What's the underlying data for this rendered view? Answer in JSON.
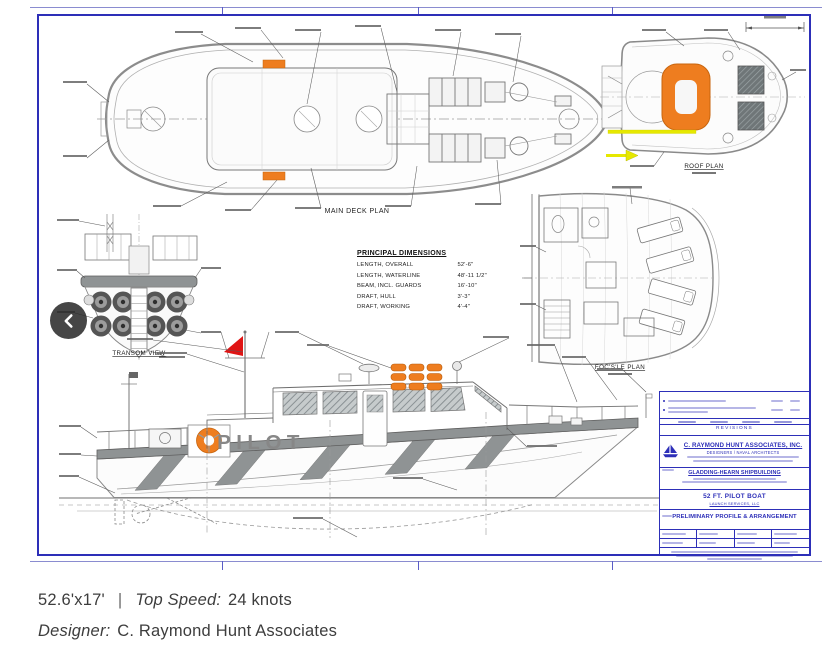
{
  "carousel": {
    "prev_icon": "chevron-left"
  },
  "caption": {
    "dimensions": "52.6'x17'",
    "separator": "|",
    "top_speed_label": "Top Speed:",
    "top_speed_value": "24 knots",
    "designer_label": "Designer:",
    "designer_value": "C. Raymond Hunt Associates"
  },
  "sheet": {
    "views": {
      "main_deck_plan": "MAIN DECK PLAN",
      "roof_plan": "ROOF PLAN",
      "transom_view": "TRANSOM VIEW",
      "focsle_plan": "FOC'S'LE PLAN",
      "hull_name": "PILOT"
    },
    "principal_dimensions": {
      "title": "PRINCIPAL DIMENSIONS",
      "rows": [
        {
          "label": "LENGTH, OVERALL",
          "value": "52'-6\""
        },
        {
          "label": "LENGTH, WATERLINE",
          "value": "48'-11 1/2\""
        },
        {
          "label": "BEAM, INCL. GUARDS",
          "value": "16'-10\""
        },
        {
          "label": "DRAFT, HULL",
          "value": "3'-3\""
        },
        {
          "label": "DRAFT, WORKING",
          "value": "4'-4\""
        }
      ]
    },
    "title_block": {
      "revisions": "REVISIONS",
      "company": "C. RAYMOND HUNT ASSOCIATES, INC.",
      "company_type": "DESIGNERS / NAVAL ARCHITECTS",
      "builder": "GLADDING-HEARN SHIPBUILDING",
      "boat": "52 FT. PILOT BOAT",
      "boat_sub": "LAUNCH SERVICES, LLC",
      "drawing": "PRELIMINARY PROFILE & ARRANGEMENT"
    },
    "colors": {
      "sheet_border": "#2d2fb8",
      "ink_blue": "#2d2fb8",
      "draft_gray": "#8f9394",
      "accent_orange": "#ee7d1f",
      "flag_red": "#e01414",
      "stripe_yellow": "#e6e800"
    }
  }
}
